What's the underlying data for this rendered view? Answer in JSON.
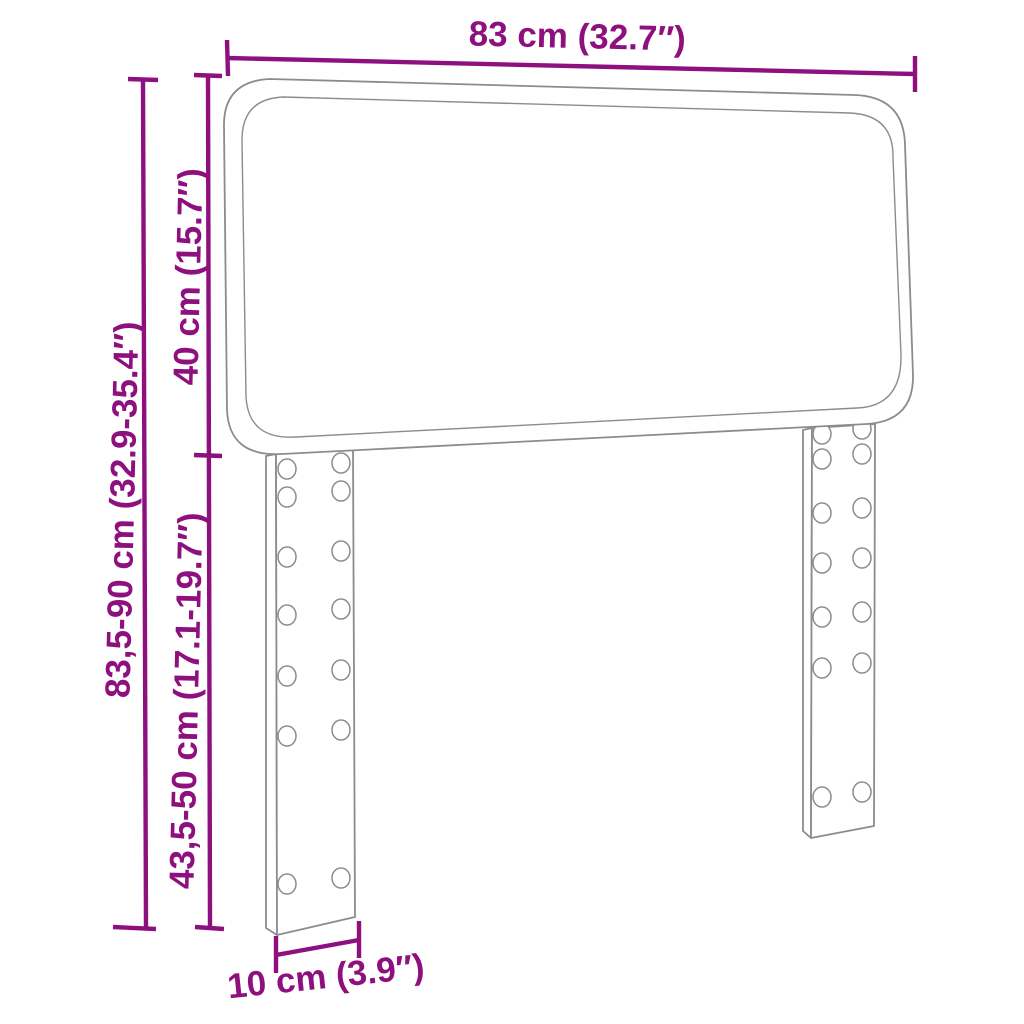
{
  "dimensions": {
    "width": {
      "label": "83 cm (32.7″)"
    },
    "total_height": {
      "label": "83,5-90 cm (32.9-35.4″)"
    },
    "headboard_height": {
      "label": "40 cm (15.7″)"
    },
    "leg_height": {
      "label": "43,5-50 cm (17.1-19.7″)"
    },
    "leg_width": {
      "label": "10 cm (3.9″)"
    }
  },
  "colors": {
    "dimension": "#8E107E",
    "outline": "#8C8C8C",
    "background": "#FFFFFF"
  }
}
